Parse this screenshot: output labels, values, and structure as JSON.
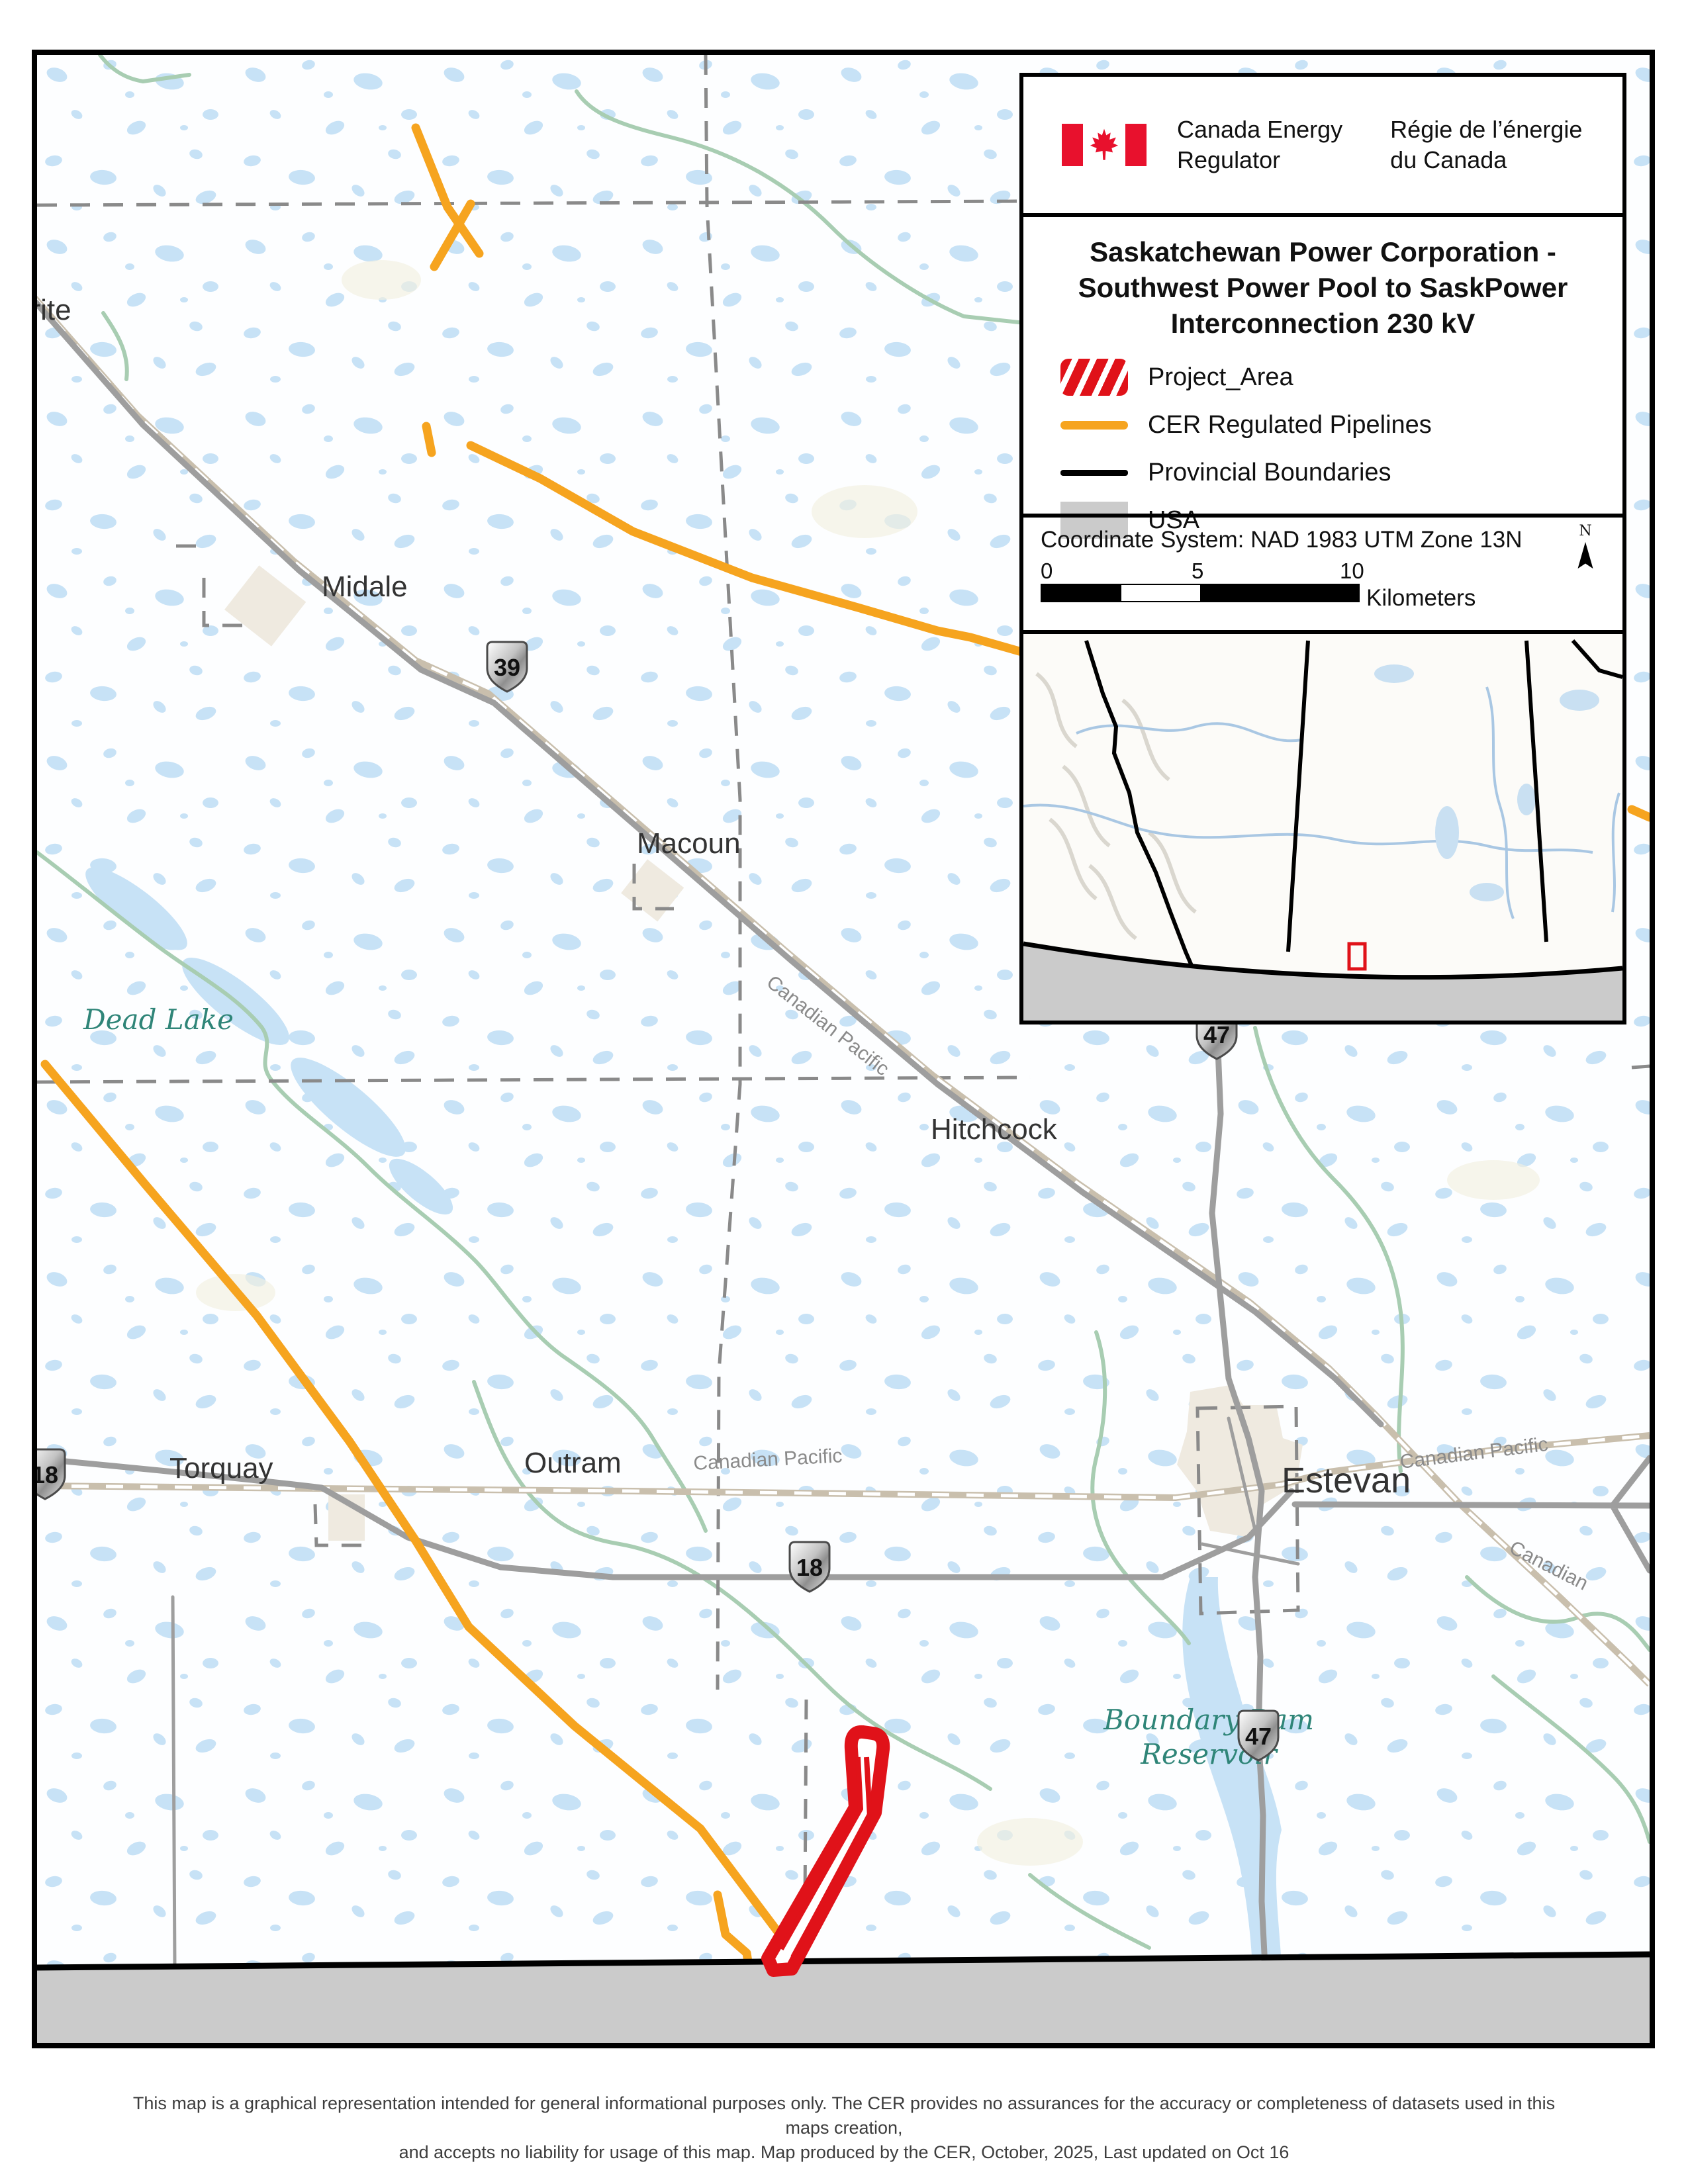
{
  "colors": {
    "pipeline_orange": "#F6A41F",
    "project_red": "#E01219",
    "usa_gray": "#CBCBCB",
    "water_blue": "#C7E2F6",
    "river_green": "#A8CDB2",
    "water_label_teal": "#2F8578",
    "road_gray": "#9E9E9E",
    "railway_tan": "#C9BFAD",
    "boundary_dash_gray": "#8A8A8A"
  },
  "legend": {
    "agency": {
      "flag_icon": "canada-flag-icon",
      "en_line1": "Canada Energy",
      "en_line2": "Regulator",
      "fr_line1": "Régie de l’énergie",
      "fr_line2": "du Canada"
    },
    "title_line1": "Saskatchewan Power Corporation -",
    "title_line2": "Southwest Power Pool to SaskPower",
    "title_line3": "Interconnection 230 kV",
    "items": [
      {
        "key": "project-area",
        "label": "Project_Area"
      },
      {
        "key": "cer-pipelines",
        "label": "CER Regulated Pipelines"
      },
      {
        "key": "provincial-boundaries",
        "label": "Provincial Boundaries"
      },
      {
        "key": "usa",
        "label": "USA"
      }
    ],
    "coordinate_system": "Coordinate System: NAD 1983 UTM Zone 13N",
    "scale_bar": {
      "ticks": [
        "0",
        "5",
        "10"
      ],
      "units": "Kilometers",
      "north_label": "N"
    }
  },
  "map": {
    "towns": {
      "halbrite_partial": "orite",
      "midale": "Midale",
      "macoun": "Macoun",
      "hitchcock": "Hitchcock",
      "torquay": "Torquay",
      "outram": "Outram",
      "estevan": "Estevan"
    },
    "water_labels": {
      "dead_lake": "Dead Lake",
      "boundary_dam_line1": "Boundary Dam",
      "boundary_dam_line2": "Reservoir"
    },
    "railway_labels": {
      "cp_main": "Canadian Pacific",
      "cp_outram": "Canadian Pacific",
      "cp_estevan_east": "Canadian Pacific",
      "cp_southeast": "Canadian"
    },
    "highway_shields": {
      "hwy39": "39",
      "hwy47_north": "47",
      "hwy47_south": "47",
      "hwy18_west": "18",
      "hwy18_central": "18"
    }
  },
  "footer": {
    "disclaimer_line1": "This map is a graphical representation intended for general informational purposes only. The CER provides no assurances for the accuracy or completeness of datasets used in this maps creation,",
    "disclaimer_line2": "and accepts no liability for usage of this map. Map produced by the CER, October, 2025, Last updated on Oct 16"
  }
}
